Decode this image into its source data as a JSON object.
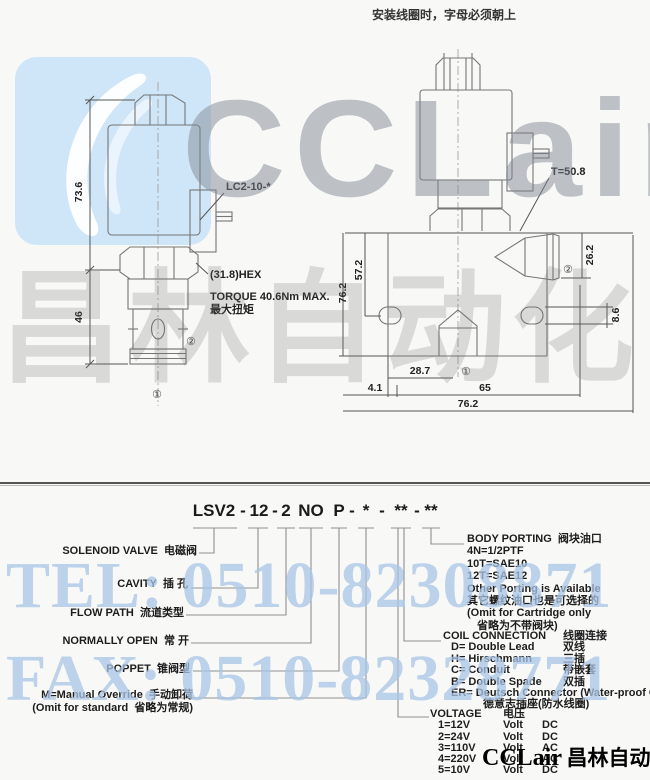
{
  "header": {
    "install_note": "安装线圈时，字母必须朝上"
  },
  "watermark": {
    "brand": "CCLair",
    "brand_cn": "昌林自动化",
    "tel": "TEL: 0510-82308871",
    "fax": "FAX: 0510-82328771",
    "logo_icon": "cclair-swoosh",
    "colors": {
      "logo_blue": "#cfe6f8",
      "gray_text": "#7d8691",
      "blue_text": "#a9c6e6"
    }
  },
  "footer_brand": {
    "latin": "CCLair",
    "cn": "昌林自动化"
  },
  "left_drawing": {
    "dim_height_coil": "73.6",
    "dim_height_body": "46",
    "coil_label": "LC2-10-*",
    "hex_label": "(31.8)HEX",
    "torque_en": "TORQUE 40.6Nm MAX.",
    "torque_cn": "最大扭矩",
    "port_side": "②",
    "port_bottom": "①"
  },
  "right_drawing": {
    "t_label": "T=50.8",
    "dim_26_2": "26.2",
    "dim_57_2": "57.2",
    "dim_76_2_vert": "76.2",
    "dim_8_6": "8.6",
    "dim_28_7": "28.7",
    "dim_65": "65",
    "dim_4_1": "4.1",
    "dim_76_2_horz": "76.2",
    "port_side": "②",
    "port_bottom": "①"
  },
  "model_code": {
    "tokens": [
      "LSV2",
      "-",
      "12",
      "-",
      "2",
      "NO",
      "P",
      "-",
      "*",
      "-",
      "**",
      "-",
      "**"
    ]
  },
  "left_callouts": [
    {
      "en": "SOLENOID VALVE",
      "cn": "电磁阀"
    },
    {
      "en": "CAVITY",
      "cn": "插 孔"
    },
    {
      "en": "FLOW PATH",
      "cn": "流道类型"
    },
    {
      "en": "NORMALLY OPEN",
      "cn": "常 开"
    },
    {
      "en": "POPPET",
      "cn": "锥阀型"
    },
    {
      "en": "M=Manual Override",
      "cn": "手动卸荷",
      "en2": "(Omit for standard",
      "cn2": "省略为常规)"
    }
  ],
  "right_callouts": {
    "body_porting": {
      "title_en": "BODY PORTING",
      "title_cn": "阀块油口",
      "lines": [
        "4N=1/2PTF",
        "10T=SAE10",
        "12T=SAE12",
        "Other Porting is Available",
        "其它螺纹油口也是可选择的",
        "(Omit for Cartridge only",
        "省略为不带阀块)"
      ]
    },
    "coil_connection": {
      "title_en": "COIL CONNECTION",
      "title_cn": "线圈连接",
      "options": [
        {
          "code_en": "D= Double Lead",
          "cn": "双线"
        },
        {
          "code_en": "H= Hirschmann",
          "cn": "三插"
        },
        {
          "code_en": "C= Conduit",
          "cn": "带嵌套"
        },
        {
          "code_en": "B= Double Spade",
          "cn": "双插"
        },
        {
          "code_en": "ER= Deutsch Connector (Water-proof Coil)",
          "cn": "德意志插座(防水线圈)"
        }
      ]
    },
    "voltage": {
      "title_en": "VOLTAGE",
      "title_cn": "电压",
      "options": [
        {
          "code": "1=12V",
          "unit": "Volt",
          "current": "DC"
        },
        {
          "code": "2=24V",
          "unit": "Volt",
          "current": "DC"
        },
        {
          "code": "3=110V",
          "unit": "Volt",
          "current": "AC"
        },
        {
          "code": "4=220V",
          "unit": "Volt",
          "current": "AC"
        },
        {
          "code": "5=10V",
          "unit": "Volt",
          "current": "DC"
        }
      ]
    }
  }
}
